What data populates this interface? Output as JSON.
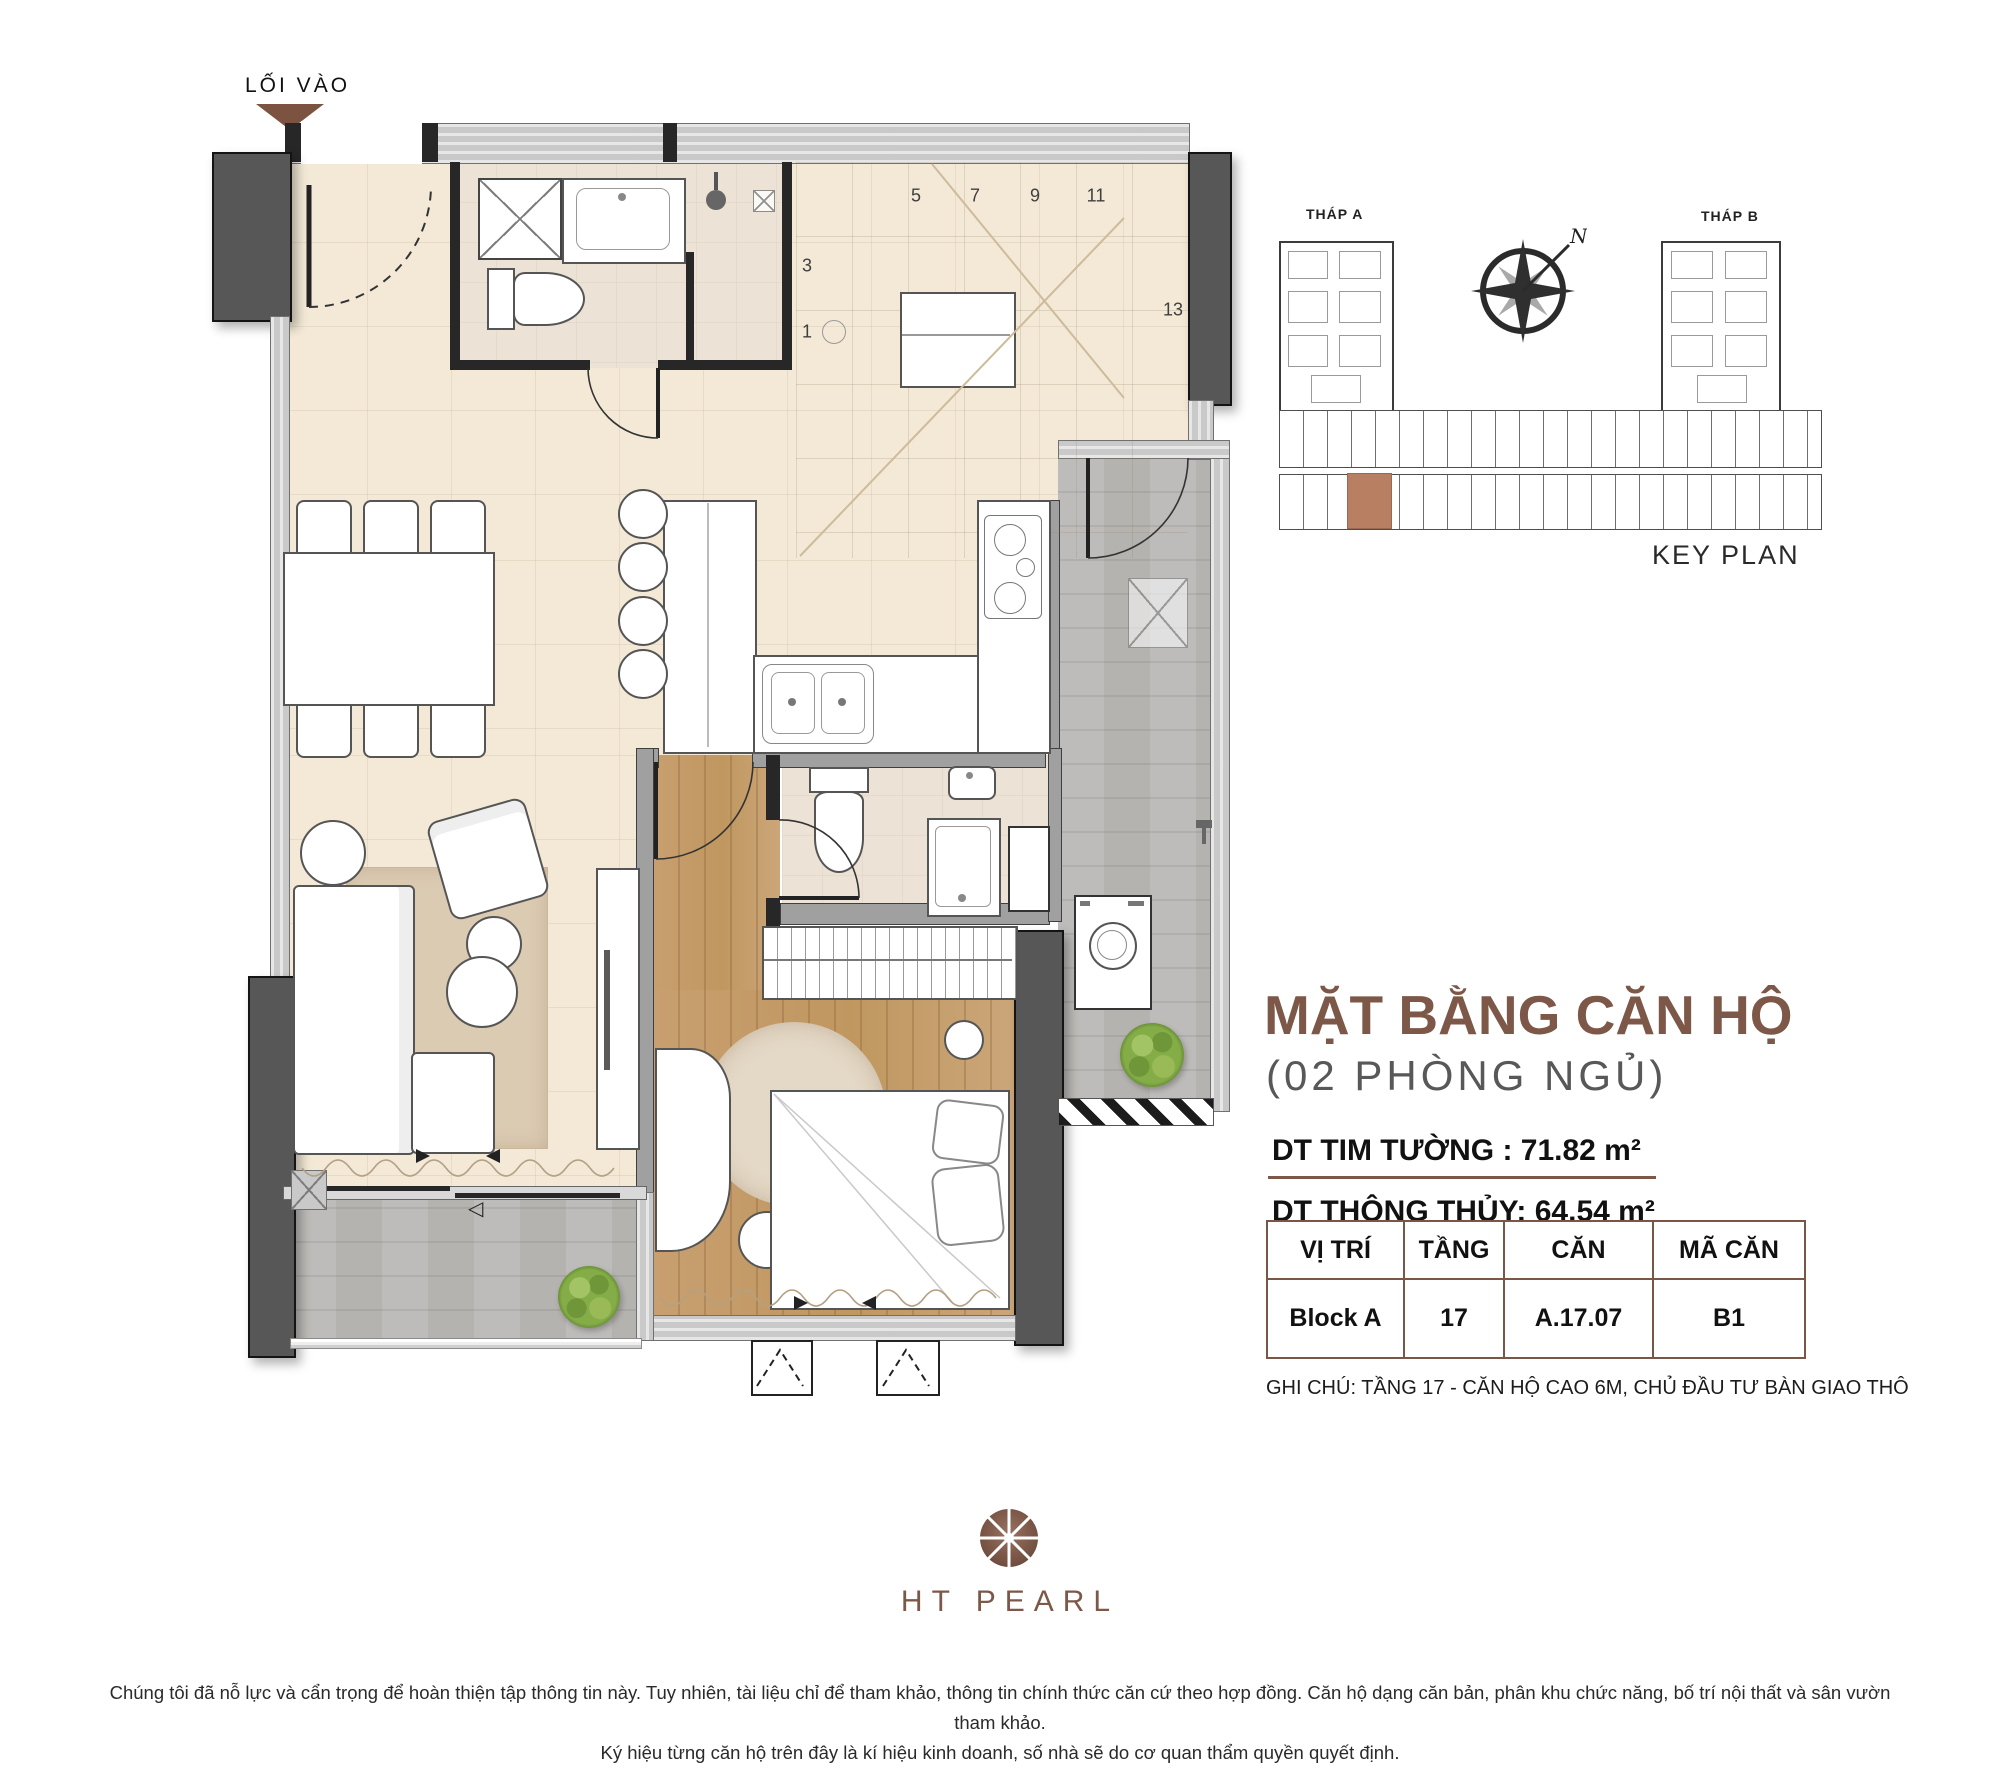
{
  "entry": {
    "label": "LỐI VÀO"
  },
  "key_plan": {
    "tower_a_label": "THÁP A",
    "tower_b_label": "THÁP B",
    "caption": "KEY PLAN",
    "north_label": "N",
    "highlight_color": "#b97f63"
  },
  "plan": {
    "stair_numbers": [
      "1",
      "3",
      "5",
      "7",
      "9",
      "11",
      "13"
    ]
  },
  "info": {
    "title": "MẶT BẰNG CĂN HỘ",
    "subtitle": "(02 PHÒNG NGỦ)",
    "area_tim_tuong": "DT TIM TƯỜNG : 71.82 m²",
    "area_thong_thuy": "DT THÔNG THỦY: 64.54 m²",
    "table": {
      "headers": [
        "VỊ TRÍ",
        "TẦNG",
        "CĂN",
        "MÃ CĂN"
      ],
      "row": [
        "Block A",
        "17",
        "A.17.07",
        "B1"
      ]
    },
    "note": "GHI CHÚ: TẦNG 17 - CĂN HỘ CAO 6M, CHỦ ĐẦU TƯ BÀN GIAO THÔ"
  },
  "logo": {
    "text": "HT PEARL"
  },
  "disclaimer": {
    "line1": "Chúng tôi đã nỗ lực và cẩn trọng để hoàn thiện tập thông tin này. Tuy nhiên, tài liệu chỉ để tham khảo, thông tin chính thức căn cứ theo hợp đồng. Căn hộ dạng căn bản, phân khu chức năng, bố trí nội thất và sân vườn tham khảo.",
    "line2": "Ký hiệu từng căn hộ trên đây là kí hiệu kinh doanh, số nhà sẽ do cơ quan thẩm quyền quyết định."
  },
  "colors": {
    "accent": "#7d5848"
  }
}
